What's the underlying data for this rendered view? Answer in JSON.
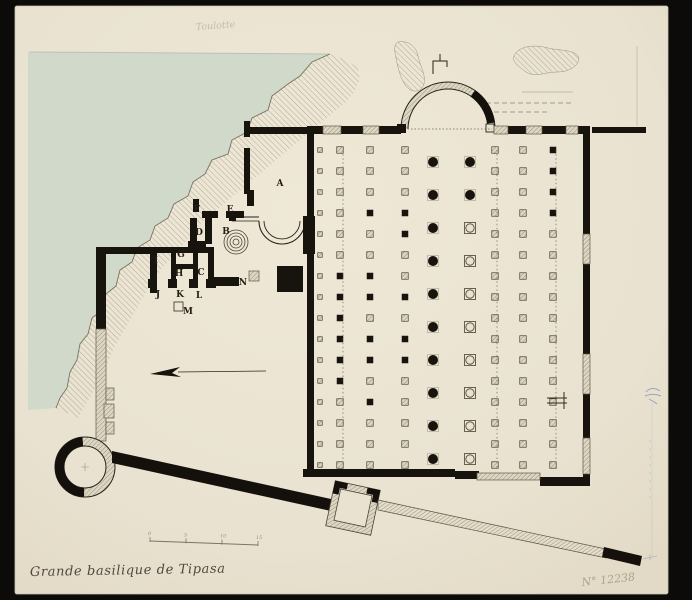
{
  "annotations": {
    "title": "Grande basilique de Tipasa",
    "catalog_number": "N° 12238",
    "pencil_note": "Toulotte"
  },
  "scale_bar": {
    "tick_labels": [
      "0",
      "5",
      "10",
      "15"
    ]
  },
  "colors": {
    "backdrop": "#0c0b09",
    "paper": "#e9e2d0",
    "sea": "#d1d9cb",
    "ink": "#17130d",
    "wall_edge": "#5e5948",
    "pier_edge": "#46412f",
    "halo": "#b8b19c",
    "blue_pencil": "#7d93b5",
    "title_ink": "#4e4840"
  },
  "plan": {
    "room_labels": [
      {
        "t": "A",
        "x": 280,
        "y": 186
      },
      {
        "t": "B",
        "x": 226,
        "y": 234
      },
      {
        "t": "C",
        "x": 201,
        "y": 275
      },
      {
        "t": "D",
        "x": 199,
        "y": 235
      },
      {
        "t": "E",
        "x": 230,
        "y": 212
      },
      {
        "t": "F",
        "x": 197,
        "y": 212
      },
      {
        "t": "G",
        "x": 181,
        "y": 257
      },
      {
        "t": "H",
        "x": 179,
        "y": 276
      },
      {
        "t": "I",
        "x": 156,
        "y": 263
      },
      {
        "t": "J",
        "x": 158,
        "y": 297
      },
      {
        "t": "K",
        "x": 180,
        "y": 297
      },
      {
        "t": "L",
        "x": 199,
        "y": 298
      },
      {
        "t": "M",
        "x": 188,
        "y": 314
      },
      {
        "t": "N",
        "x": 243,
        "y": 285
      }
    ],
    "basilica": {
      "wall_black": [
        [
          307,
          126,
          16,
          8
        ],
        [
          341,
          126,
          22,
          8
        ],
        [
          379,
          126,
          22,
          8
        ],
        [
          508,
          126,
          18,
          8
        ],
        [
          542,
          126,
          26,
          8
        ],
        [
          578,
          126,
          12,
          8
        ],
        [
          592,
          127,
          54,
          6
        ],
        [
          307,
          134,
          7,
          336
        ],
        [
          583,
          134,
          7,
          100
        ],
        [
          583,
          264,
          7,
          90
        ],
        [
          583,
          394,
          7,
          44
        ],
        [
          583,
          474,
          7,
          12
        ],
        [
          303,
          469,
          152,
          8
        ],
        [
          455,
          471,
          24,
          8
        ],
        [
          540,
          477,
          50,
          9
        ],
        [
          397,
          124,
          9,
          9
        ]
      ],
      "wall_hatch": [
        [
          323,
          126,
          18,
          8
        ],
        [
          363,
          126,
          16,
          8
        ],
        [
          494,
          126,
          14,
          8
        ],
        [
          526,
          126,
          16,
          8
        ],
        [
          566,
          126,
          12,
          8
        ],
        [
          583,
          234,
          7,
          30
        ],
        [
          583,
          354,
          7,
          40
        ],
        [
          583,
          438,
          7,
          36
        ],
        [
          477,
          473,
          63,
          7
        ]
      ],
      "pier_rows": {
        "y0": 150,
        "step": 21,
        "count": 16
      },
      "pier_cols": [
        {
          "x": 320,
          "s": 4.5,
          "p": "hhhhhhhhhhhhhhhh"
        },
        {
          "x": 340,
          "p": "hhhhhhsssssshhhh"
        },
        {
          "x": 370,
          "p": "hhhshhsshsshshhh"
        },
        {
          "x": 405,
          "p": "hhhsshhshsshhhhh"
        },
        {
          "x": 495,
          "p": "hhhhhhhhhhhhhhhh"
        },
        {
          "x": 523,
          "p": "hhhhhhhhhhhhhhhh"
        },
        {
          "x": 553,
          "p": "sssshhhhhhhhhhhh"
        }
      ],
      "circle_rows": {
        "y0": 162,
        "step": 33,
        "count": 10
      },
      "circle_cols": [
        {
          "x": 433,
          "p": "cccccccccc"
        },
        {
          "x": 470,
          "p": "ccoooooooo"
        }
      ],
      "dotted_vlines": [
        343,
        497,
        556
      ]
    },
    "cluster": {
      "black": [
        [
          244,
          121,
          6,
          16
        ],
        [
          244,
          148,
          6,
          46
        ],
        [
          250,
          127,
          58,
          7
        ],
        [
          193,
          199,
          6,
          13
        ],
        [
          202,
          211,
          16,
          7
        ],
        [
          226,
          211,
          18,
          7
        ],
        [
          247,
          190,
          7,
          16
        ],
        [
          190,
          218,
          7,
          30
        ],
        [
          205,
          218,
          7,
          26
        ],
        [
          188,
          241,
          18,
          6
        ],
        [
          229,
          214,
          7,
          7
        ],
        [
          303,
          216,
          12,
          38
        ],
        [
          150,
          247,
          62,
          6
        ],
        [
          150,
          247,
          7,
          46
        ],
        [
          171,
          247,
          5,
          38
        ],
        [
          193,
          247,
          5,
          38
        ],
        [
          208,
          247,
          6,
          38
        ],
        [
          171,
          264,
          27,
          5
        ],
        [
          148,
          279,
          8,
          9
        ],
        [
          168,
          279,
          9,
          9
        ],
        [
          189,
          279,
          9,
          9
        ],
        [
          206,
          279,
          10,
          9
        ],
        [
          213,
          277,
          26,
          9
        ],
        [
          277,
          266,
          26,
          26
        ],
        [
          96,
          247,
          10,
          82
        ],
        [
          103,
          247,
          49,
          7
        ]
      ],
      "hatch": [
        [
          96,
          329,
          10,
          112
        ],
        [
          106,
          388,
          8,
          12
        ],
        [
          104,
          404,
          10,
          14
        ],
        [
          106,
          422,
          8,
          12
        ],
        [
          249,
          271,
          10,
          10
        ]
      ],
      "open_squares": [
        [
          174,
          302,
          9,
          9
        ]
      ]
    }
  }
}
